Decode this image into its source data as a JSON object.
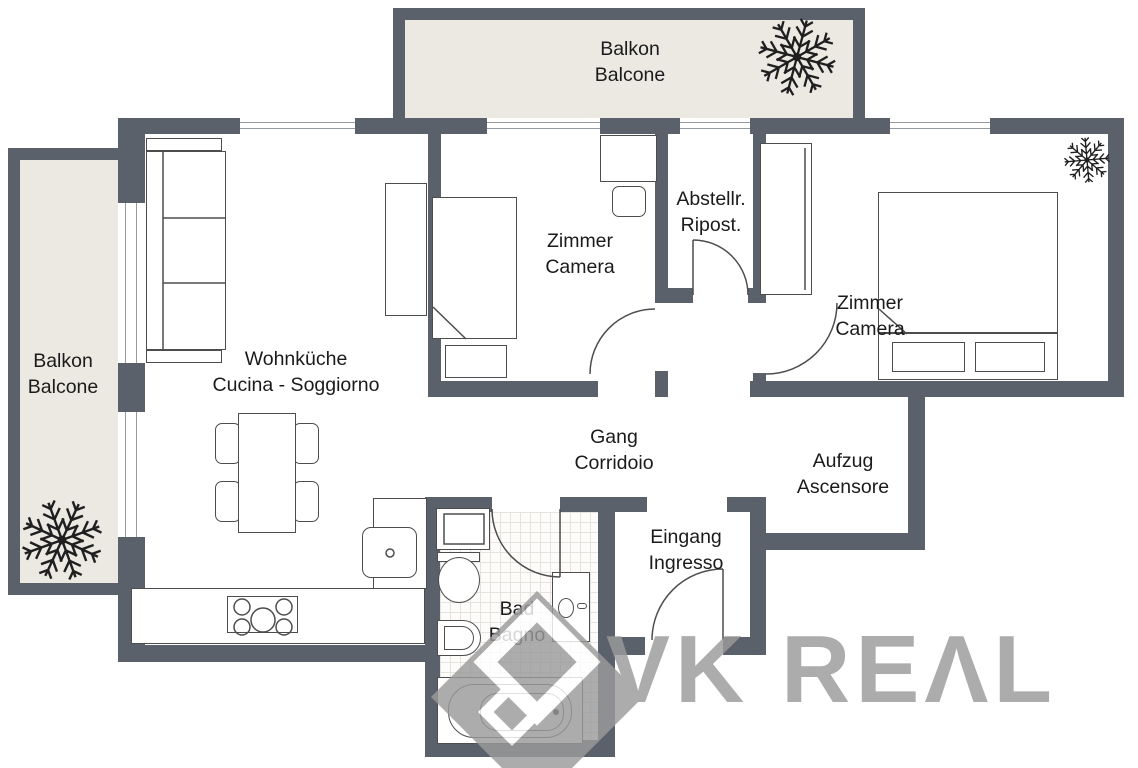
{
  "title": "Apartment floor plan",
  "colors": {
    "wall": "#5a616b",
    "balcony": "#ece9e3",
    "floor": "#ffffff",
    "line": "#4d4d4d",
    "text": "#1b1b1b",
    "tile": "#e6e2dd",
    "watermark": "#9b9b9b"
  },
  "rooms": {
    "balcony_top": {
      "name_de": "Balkon",
      "name_it": "Balcone"
    },
    "balcony_left": {
      "name_de": "Balkon",
      "name_it": "Balcone"
    },
    "living": {
      "name_de": "Wohnküche",
      "name_it": "Cucina - Soggiorno"
    },
    "bedroom1": {
      "name_de": "Zimmer",
      "name_it": "Camera"
    },
    "storage": {
      "name_de": "Abstellr.",
      "name_it": "Ripost."
    },
    "bedroom2": {
      "name_de": "Zimmer",
      "name_it": "Camera"
    },
    "corridor": {
      "name_de": "Gang",
      "name_it": "Corridoio"
    },
    "elevator": {
      "name_de": "Aufzug",
      "name_it": "Ascensore"
    },
    "entrance": {
      "name_de": "Eingang",
      "name_it": "Ingresso"
    },
    "bathroom": {
      "name_de": "Bad",
      "name_it": "Bagno"
    }
  },
  "watermark": {
    "brand": "VK REΛL"
  }
}
